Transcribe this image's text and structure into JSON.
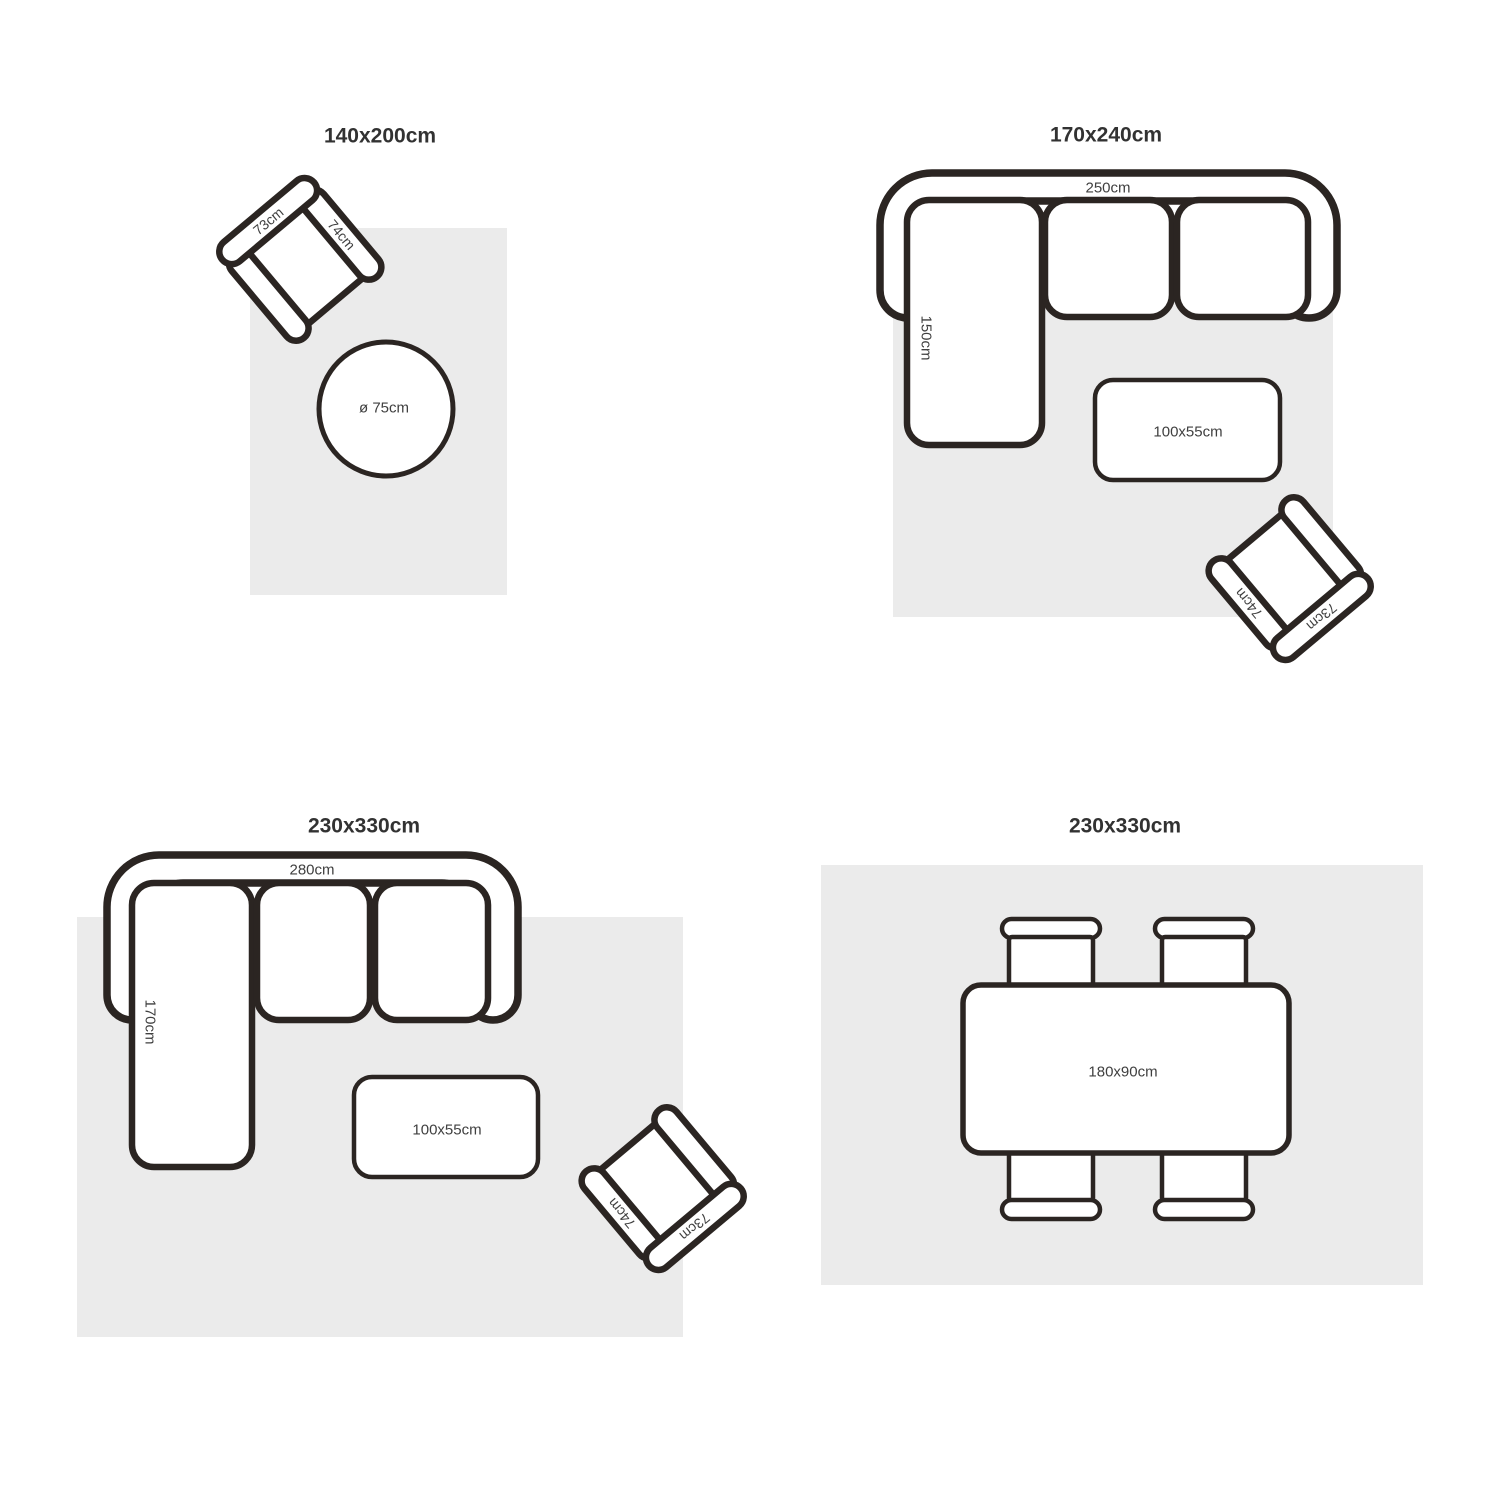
{
  "style": {
    "background": "#ffffff",
    "rug_color": "#ebebeb",
    "line_color": "#2b2522",
    "title_color": "#323232",
    "label_color": "#3f3f3f"
  },
  "quadrants": [
    {
      "title": "140x200cm",
      "furniture": {
        "armchair": {
          "back_label": "73cm",
          "arm_label": "74cm"
        },
        "round_table": {
          "label": "ø 75cm"
        }
      }
    },
    {
      "title": "170x240cm",
      "furniture": {
        "sofa": {
          "width_label": "250cm",
          "depth_label": "150cm"
        },
        "coffee_table": {
          "label": "100x55cm"
        },
        "armchair": {
          "back_label": "73cm",
          "arm_label": "74cm"
        }
      }
    },
    {
      "title": "230x330cm",
      "furniture": {
        "sofa": {
          "width_label": "280cm",
          "depth_label": "170cm"
        },
        "coffee_table": {
          "label": "100x55cm"
        },
        "armchair": {
          "back_label": "73cm",
          "arm_label": "74cm"
        }
      }
    },
    {
      "title": "230x330cm",
      "furniture": {
        "dining_table": {
          "label": "180x90cm"
        }
      }
    }
  ]
}
